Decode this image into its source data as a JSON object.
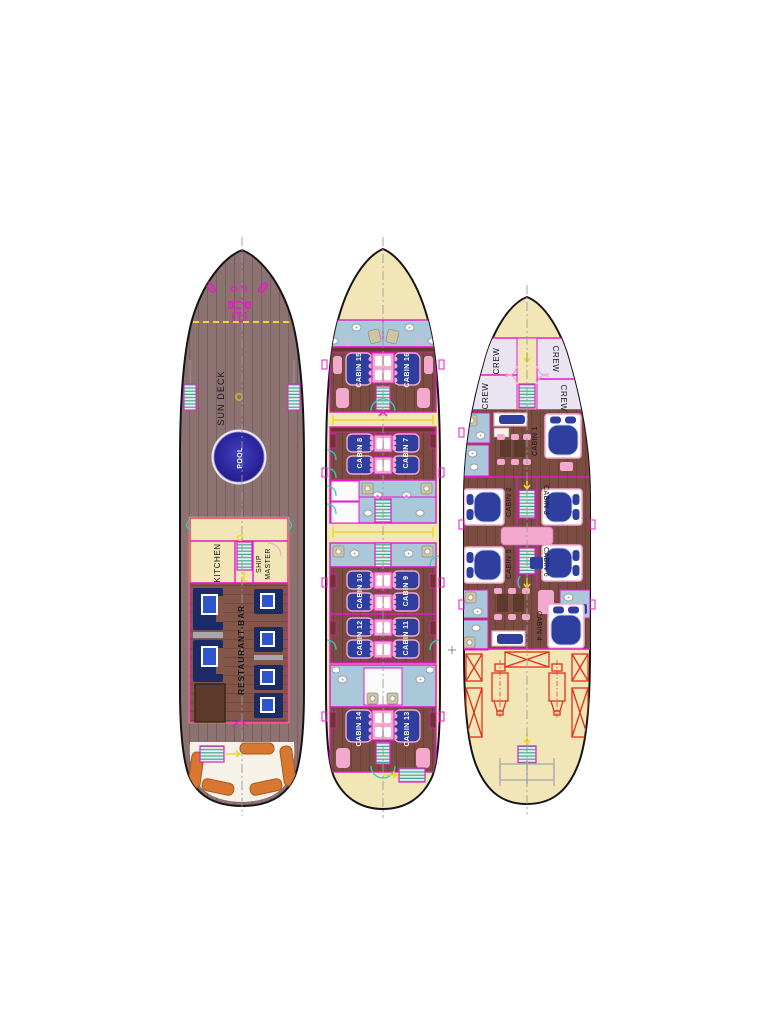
{
  "palette": {
    "background": "#ffffff",
    "hull_outline": "#151515",
    "deck_wood": "#8d7272",
    "cabin_floor": "#7b4c42",
    "restaurant_floor": "#84564a",
    "cream": "#f3e6b6",
    "bathroom_blue": "#abc7da",
    "crew_lavender": "#e9e3f2",
    "bed_navy": "#2e3f9f",
    "sofa_navy": "#1c2a66",
    "table_blue": "#2f55cc",
    "pink": "#f3a8ce",
    "magenta_wall": "#e619c9",
    "teal": "#38cdbd",
    "yellow": "#eed62b",
    "pool_blue": "#251d95",
    "cushion_orange": "#d8772f",
    "engine_red": "#e23018",
    "centerline_gray": "#9a9a9a"
  },
  "sun_deck": {
    "labels": {
      "sun_deck": "SUN DECK",
      "pool": "POOL",
      "kitchen": "KITCHEN",
      "ship": "SHIP",
      "master": "MASTER",
      "restaurant_bar": "RESTAURANT-BAR"
    }
  },
  "main_deck": {
    "cabins": [
      "CABIN 15",
      "CABIN 16",
      "CABIN 8",
      "CABIN 7",
      "CABIN 10",
      "CABIN 9",
      "CABIN 12",
      "CABIN 11",
      "CABIN 14",
      "CABIN 13"
    ]
  },
  "lower_deck": {
    "crew": [
      "CREW",
      "CREW",
      "CREW",
      "CREW"
    ],
    "cabins": [
      "CABIN 1",
      "CABIN 2",
      "CABIN 3",
      "CABIN 5",
      "CABIN 6",
      "CABIN 4"
    ]
  }
}
